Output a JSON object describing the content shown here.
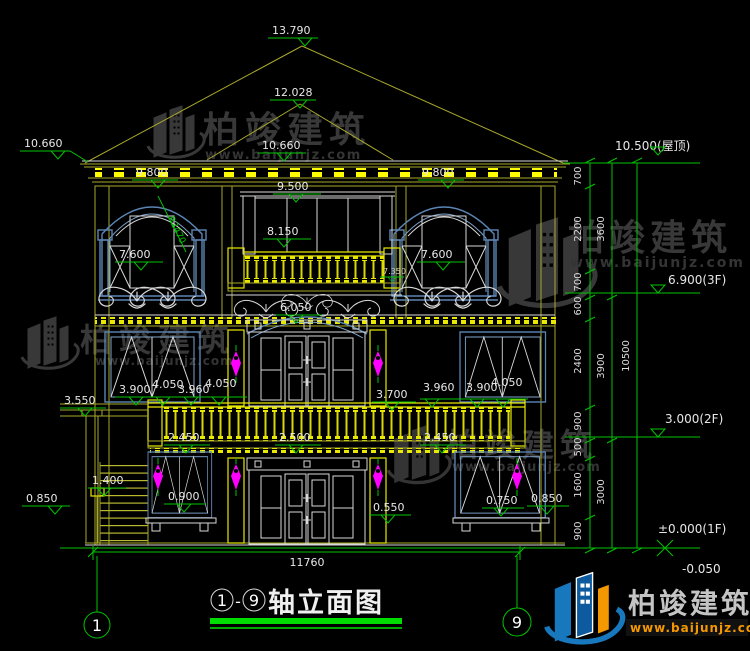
{
  "levels": {
    "apex": "13.790",
    "ridge": "12.028",
    "eave_left": "10.660",
    "eave_center": "10.660",
    "cornice_left": "9.800",
    "cornice_right": "9.800",
    "f3_center": "9.500",
    "f3_balcony": "8.150",
    "f3_win_left": "7.600",
    "f3_win_right": "7.600",
    "f3_small": "7.350",
    "pediment": "6.050",
    "porch": "3.550",
    "f2_a": "3.900",
    "f2_b": "4.050",
    "f2_c": "3.960",
    "f2_d": "4.050",
    "f2_door_right": "3.700",
    "f2_ra": "3.960",
    "f2_rb": "3.900",
    "f2_rc": "4.050",
    "balcony_left": "2.450",
    "balcony_center": "2.500",
    "balcony_right": "2.450",
    "stairs": "1.400",
    "base_left": "0.850",
    "f1_win_left": "0.900",
    "f1_door": "0.550",
    "f1_win_right": "0.750",
    "base_right": "0.850"
  },
  "radius_note": "R2470",
  "bottom_dim": "11760",
  "right": {
    "levels": {
      "roof": "10.500(屋顶)",
      "f3": "6.900(3F)",
      "f2": "3.000(2F)",
      "f1": "±0.000(1F)",
      "minus": "-0.050"
    },
    "col1": [
      "700",
      "2200",
      "700",
      "600",
      "2400",
      "900",
      "500",
      "1600",
      "900"
    ],
    "col2": [
      "3600",
      "3900",
      "3000"
    ],
    "col3": "10500"
  },
  "axis": {
    "left": "1",
    "right": "9"
  },
  "title": {
    "left_bubble": "1",
    "dash": "-",
    "right_bubble": "9",
    "text": "轴立面图"
  },
  "watermark": {
    "brand": "柏竣建筑",
    "url": "www.baijunjz.com"
  },
  "colors": {
    "background": "#000000",
    "dimension_green": "#00c400",
    "structure_yellow": "#a8a82a",
    "highlight_yellow": "#ffff00",
    "frame_blue": "#5c85b5",
    "detail_white": "#d8d8d8",
    "ornament_magenta": "#ff00ff",
    "underline_green": "#00dd00",
    "logo_blue": "#1878be",
    "logo_orange": "#f39800"
  }
}
